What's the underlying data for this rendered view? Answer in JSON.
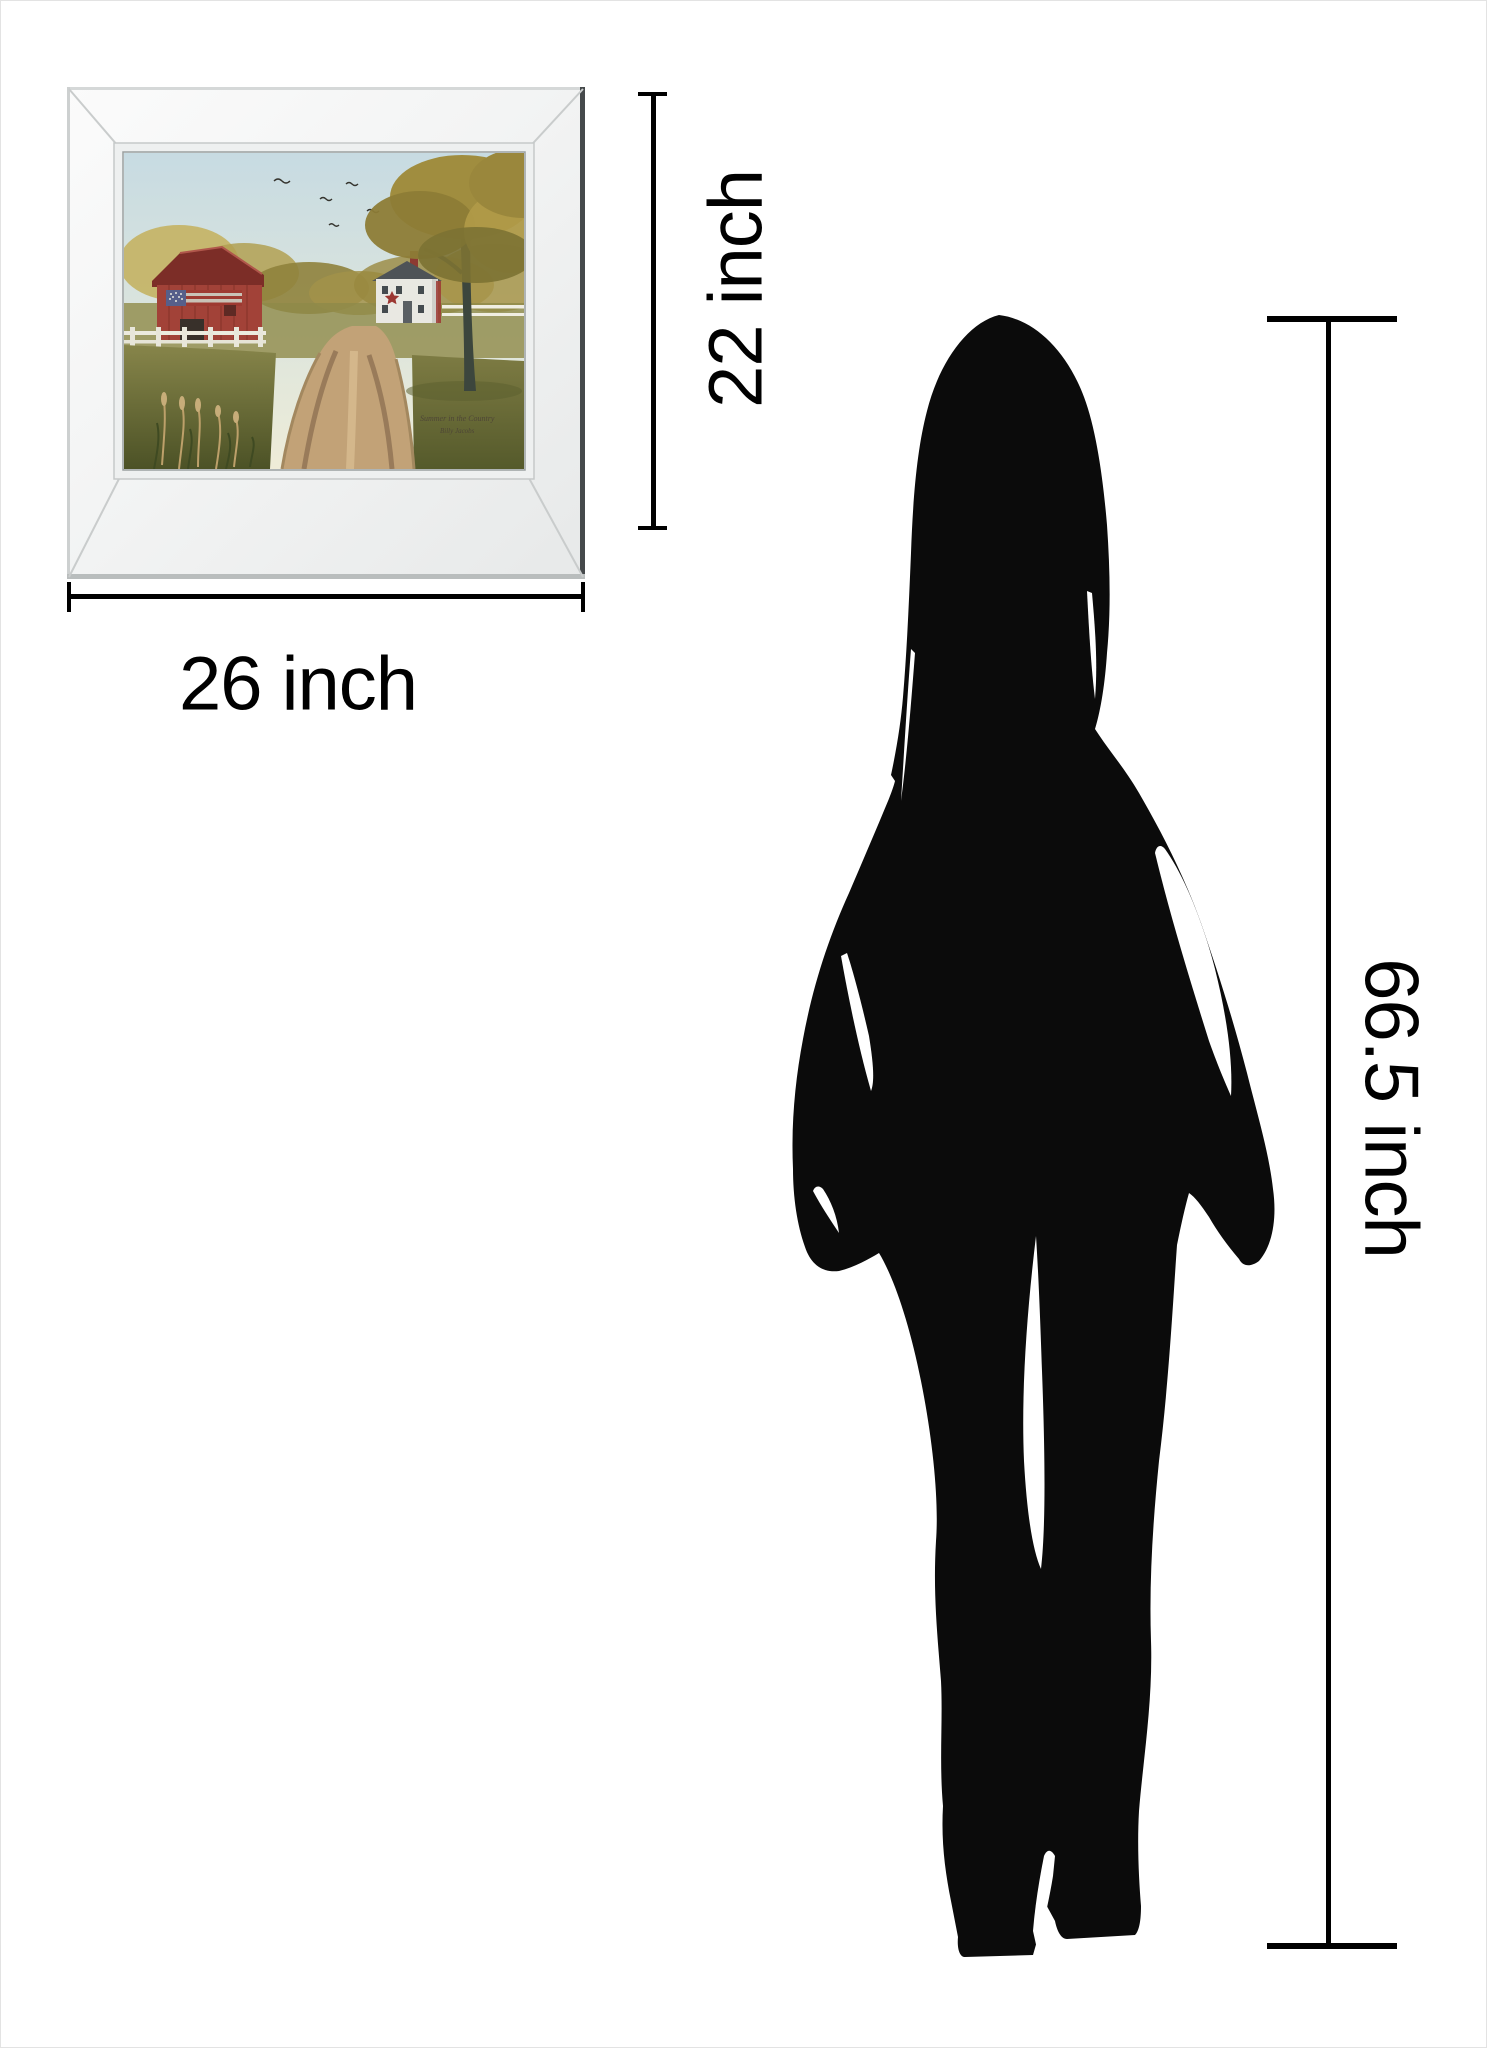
{
  "meta": {
    "description": "Product size diagram: mirrored-frame wall art compared with woman silhouette"
  },
  "dimension_labels": {
    "frame_height": "22 inch",
    "frame_width": "26 inch",
    "person_height": "66.5 inch"
  },
  "artwork": {
    "signature_title": "Summer in the Country",
    "signature_artist": "Billy Jacobs"
  },
  "colors": {
    "dimension_line": "#000000",
    "silhouette": "#0b0b0b",
    "frame_band": "#f3f4f4",
    "barn_red": "#a03b31",
    "sky_blue": "#ccdde3",
    "road_tan": "#c2a277",
    "grass_olive": "#6e7039",
    "foliage_gold": "#a5914a"
  }
}
